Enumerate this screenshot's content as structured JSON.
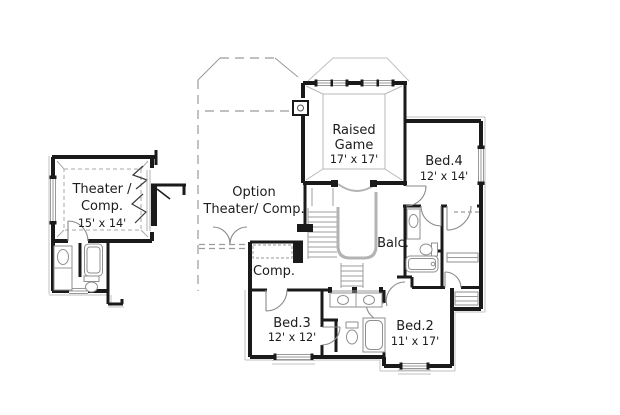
{
  "colors": {
    "background": "#ffffff",
    "wall": "#1a1a1a",
    "thin_line": "#999999",
    "offset_line": "#c2c2c2",
    "dashed_line": "#9a9a9a",
    "railing": "#b3b3b3",
    "text": "#1c1c1c"
  },
  "rooms": {
    "theater": {
      "line1": "Theater /",
      "line2": "Comp.",
      "dims": "15' x 14'"
    },
    "option_theater": {
      "line1": "Option",
      "line2": "Theater/ Comp."
    },
    "raised_game": {
      "line1": "Raised",
      "line2": "Game",
      "dims": "17' x 17'"
    },
    "bed4": {
      "name": "Bed.4",
      "dims": "12' x 14'"
    },
    "balcony": {
      "name": "Balc."
    },
    "computer_nook": {
      "name": "Comp."
    },
    "bed3": {
      "name": "Bed.3",
      "dims": "12' x 12'"
    },
    "bed2": {
      "name": "Bed.2",
      "dims": "11' x 17'"
    }
  }
}
